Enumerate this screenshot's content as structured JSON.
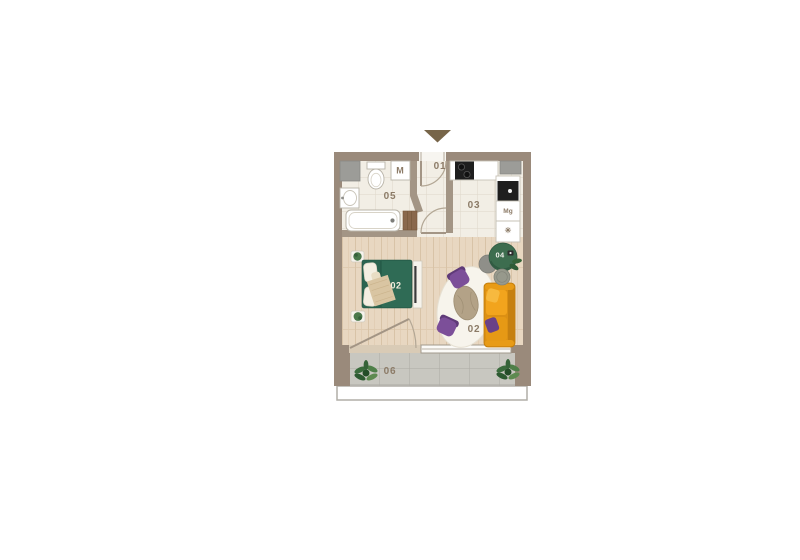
{
  "floorplan": {
    "labels": {
      "hallway": "01",
      "bedroom_area": "02",
      "living_area": "02",
      "kitchen": "03",
      "reading_corner": "04",
      "bathroom": "05",
      "balcony": "06",
      "washing_machine": "M",
      "fridge": "Mg",
      "freezer": "✳"
    },
    "colors": {
      "outer_wall": "#9a8a7b",
      "inner_wall": "#a39585",
      "wood_floor": "#e8d7c1",
      "tile_floor": "#f2eee5",
      "balcony_tile": "#c8c7c0",
      "entrance_arrow": "#776549",
      "label_text": "#8c7b67",
      "bed_green": "#2b6450",
      "sofa_orange": "#dc9013",
      "chair_purple": "#7c4f99",
      "armchair_green": "#3d6d4f",
      "plant_green": "#49784a"
    }
  }
}
